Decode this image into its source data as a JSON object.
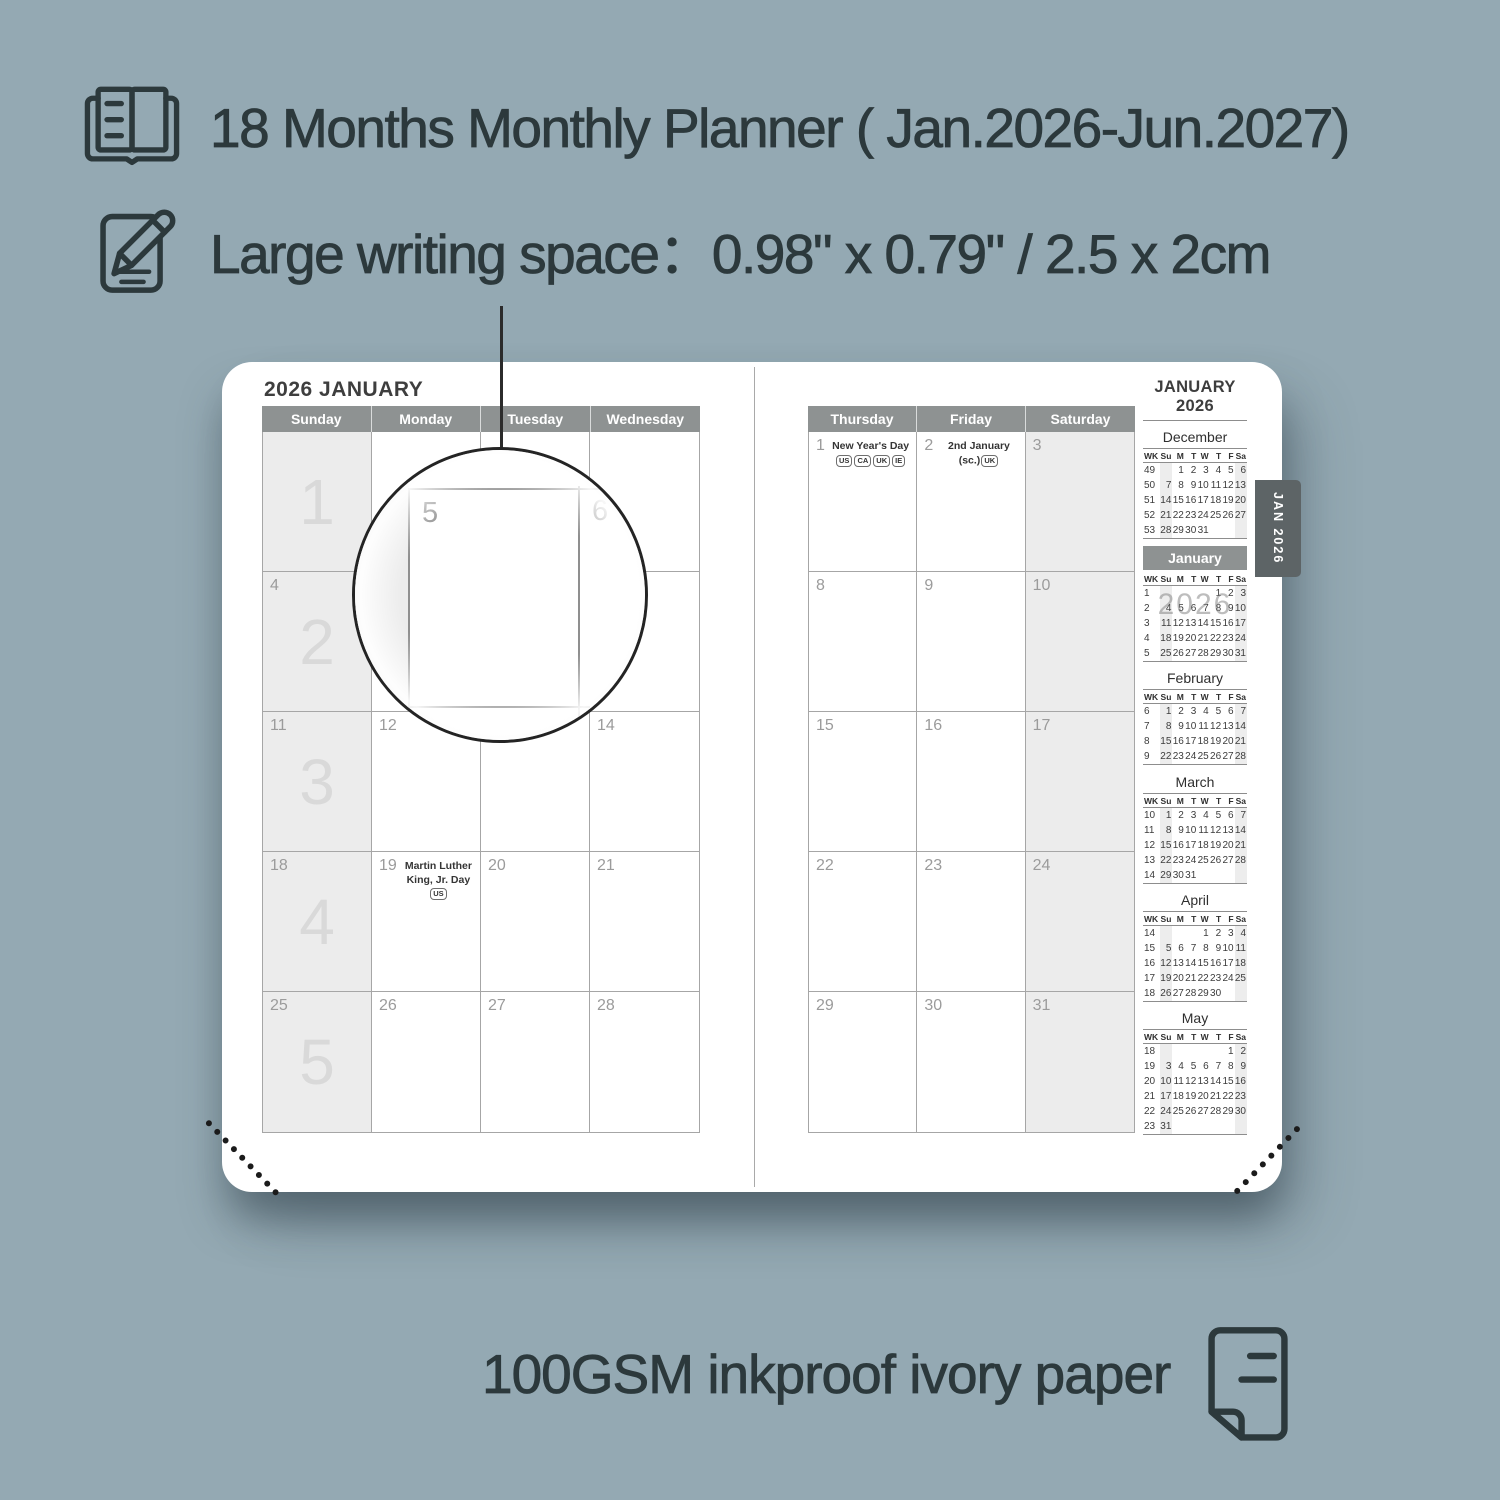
{
  "colors": {
    "background": "#94a9b3",
    "ink": "#2c393c",
    "header_bar": "#8e9292",
    "shaded_cell": "#ececec",
    "tab": "#5d6466",
    "page": "#ffffff"
  },
  "features": [
    {
      "icon": "planner-book-icon",
      "label": "18 Months Monthly Planner ( Jan.2026-Jun.2027)"
    },
    {
      "icon": "pencil-icon",
      "label": "Large writing space：0.98\" x 0.79\" / 2.5 x 2cm"
    }
  ],
  "planner": {
    "tab_label": "JAN 2026",
    "magnifier": {
      "day_labels": [
        "5",
        "6"
      ]
    },
    "left_page": {
      "title": "2026 JANUARY",
      "day_headers": [
        "Sunday",
        "Monday",
        "Tuesday",
        "Wednesday"
      ],
      "weeks": [
        {
          "week": "1",
          "days": [
            {
              "d": ""
            },
            {
              "d": ""
            },
            {
              "d": ""
            },
            {
              "d": ""
            }
          ]
        },
        {
          "week": "2",
          "days": [
            {
              "d": "4"
            },
            {
              "d": "5"
            },
            {
              "d": "6"
            },
            {
              "d": "7"
            }
          ]
        },
        {
          "week": "3",
          "days": [
            {
              "d": "11"
            },
            {
              "d": "12"
            },
            {
              "d": "13"
            },
            {
              "d": "14"
            }
          ]
        },
        {
          "week": "4",
          "days": [
            {
              "d": "18"
            },
            {
              "d": "19",
              "holiday": "Martin Luther King, Jr. Day",
              "badges": [
                "US"
              ]
            },
            {
              "d": "20"
            },
            {
              "d": "21"
            }
          ]
        },
        {
          "week": "5",
          "days": [
            {
              "d": "25"
            },
            {
              "d": "26"
            },
            {
              "d": "27"
            },
            {
              "d": "28"
            }
          ]
        }
      ]
    },
    "right_page": {
      "title": "JANUARY 2026",
      "day_headers": [
        "Thursday",
        "Friday",
        "Saturday"
      ],
      "weeks": [
        {
          "days": [
            {
              "d": "1",
              "holiday": "New Year's Day",
              "badges": [
                "US",
                "CA",
                "UK",
                "IE"
              ]
            },
            {
              "d": "2",
              "holiday": "2nd January (sc.)",
              "badges": [
                "UK"
              ]
            },
            {
              "d": "3"
            }
          ]
        },
        {
          "days": [
            {
              "d": "8"
            },
            {
              "d": "9"
            },
            {
              "d": "10"
            }
          ]
        },
        {
          "days": [
            {
              "d": "15"
            },
            {
              "d": "16"
            },
            {
              "d": "17"
            }
          ]
        },
        {
          "days": [
            {
              "d": "22"
            },
            {
              "d": "23"
            },
            {
              "d": "24"
            }
          ]
        },
        {
          "days": [
            {
              "d": "29"
            },
            {
              "d": "30"
            },
            {
              "d": "31"
            }
          ]
        }
      ]
    },
    "sidebar": {
      "columns": [
        "WK",
        "Su",
        "M",
        "T",
        "W",
        "T",
        "F",
        "Sa"
      ],
      "months": [
        {
          "name": "December",
          "rows": [
            [
              "49",
              "",
              "1",
              "2",
              "3",
              "4",
              "5",
              "6"
            ],
            [
              "50",
              "7",
              "8",
              "9",
              "10",
              "11",
              "12",
              "13"
            ],
            [
              "51",
              "14",
              "15",
              "16",
              "17",
              "18",
              "19",
              "20"
            ],
            [
              "52",
              "21",
              "22",
              "23",
              "24",
              "25",
              "26",
              "27"
            ],
            [
              "53",
              "28",
              "29",
              "30",
              "31",
              "",
              "",
              ""
            ]
          ]
        },
        {
          "name": "January",
          "highlight": true,
          "watermark": "2026",
          "rows": [
            [
              "1",
              "",
              "",
              "",
              "",
              "1",
              "2",
              "3"
            ],
            [
              "2",
              "4",
              "5",
              "6",
              "7",
              "8",
              "9",
              "10"
            ],
            [
              "3",
              "11",
              "12",
              "13",
              "14",
              "15",
              "16",
              "17"
            ],
            [
              "4",
              "18",
              "19",
              "20",
              "21",
              "22",
              "23",
              "24"
            ],
            [
              "5",
              "25",
              "26",
              "27",
              "28",
              "29",
              "30",
              "31"
            ]
          ]
        },
        {
          "name": "February",
          "rows": [
            [
              "6",
              "1",
              "2",
              "3",
              "4",
              "5",
              "6",
              "7"
            ],
            [
              "7",
              "8",
              "9",
              "10",
              "11",
              "12",
              "13",
              "14"
            ],
            [
              "8",
              "15",
              "16",
              "17",
              "18",
              "19",
              "20",
              "21"
            ],
            [
              "9",
              "22",
              "23",
              "24",
              "25",
              "26",
              "27",
              "28"
            ]
          ]
        },
        {
          "name": "March",
          "rows": [
            [
              "10",
              "1",
              "2",
              "3",
              "4",
              "5",
              "6",
              "7"
            ],
            [
              "11",
              "8",
              "9",
              "10",
              "11",
              "12",
              "13",
              "14"
            ],
            [
              "12",
              "15",
              "16",
              "17",
              "18",
              "19",
              "20",
              "21"
            ],
            [
              "13",
              "22",
              "23",
              "24",
              "25",
              "26",
              "27",
              "28"
            ],
            [
              "14",
              "29",
              "30",
              "31",
              "",
              "",
              "",
              ""
            ]
          ]
        },
        {
          "name": "April",
          "rows": [
            [
              "14",
              "",
              "",
              "",
              "1",
              "2",
              "3",
              "4"
            ],
            [
              "15",
              "5",
              "6",
              "7",
              "8",
              "9",
              "10",
              "11"
            ],
            [
              "16",
              "12",
              "13",
              "14",
              "15",
              "16",
              "17",
              "18"
            ],
            [
              "17",
              "19",
              "20",
              "21",
              "22",
              "23",
              "24",
              "25"
            ],
            [
              "18",
              "26",
              "27",
              "28",
              "29",
              "30",
              "",
              ""
            ]
          ]
        },
        {
          "name": "May",
          "rows": [
            [
              "18",
              "",
              "",
              "",
              "",
              "",
              "1",
              "2"
            ],
            [
              "19",
              "3",
              "4",
              "5",
              "6",
              "7",
              "8",
              "9"
            ],
            [
              "20",
              "10",
              "11",
              "12",
              "13",
              "14",
              "15",
              "16"
            ],
            [
              "21",
              "17",
              "18",
              "19",
              "20",
              "21",
              "22",
              "23"
            ],
            [
              "22",
              "24",
              "25",
              "26",
              "27",
              "28",
              "29",
              "30"
            ],
            [
              "23",
              "31",
              "",
              "",
              "",
              "",
              "",
              ""
            ]
          ]
        }
      ]
    }
  },
  "footer": {
    "icon": "paper-icon",
    "caption": "100GSM inkproof ivory paper"
  }
}
